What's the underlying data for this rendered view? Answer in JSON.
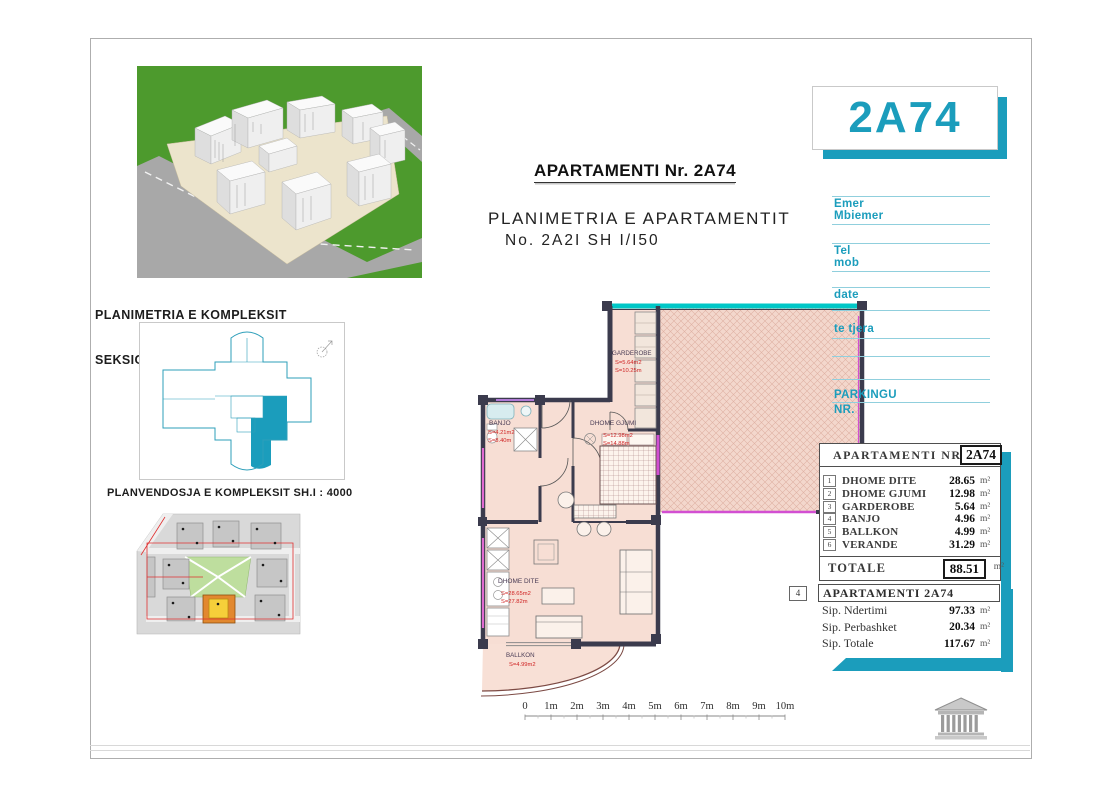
{
  "titles": {
    "main": "APARTAMENTI Nr. 2A74",
    "sub1": "PLANIMETRIA E APARTAMENTIT",
    "sub2": "No. 2A2I SH I/I50"
  },
  "left_panel": {
    "title1": "PLANIMETRIA E KOMPLEKSIT",
    "title2": "SEKSIONI 2  SH I/750",
    "site_title": "PLANVENDOSJA E KOMPLEKSIT SH.I : 4000"
  },
  "badge": {
    "text": "2A74"
  },
  "contact_form": {
    "f1a": "Emer",
    "f1b": "Mbiemer",
    "f2a": "Tel",
    "f2b": "mob",
    "f3": "date",
    "f4": "te tjera",
    "f5a": "PARKINGU",
    "f5b": "NR."
  },
  "area_table": {
    "title": "APARTAMENTI NR.",
    "unit_no": "2A74",
    "rows": [
      {
        "n": "1",
        "name": "DHOME DITE",
        "val": "28.65",
        "u": "m²"
      },
      {
        "n": "2",
        "name": "DHOME GJUMI",
        "val": "12.98",
        "u": "m²"
      },
      {
        "n": "3",
        "name": "GARDEROBE",
        "val": "5.64",
        "u": "m²"
      },
      {
        "n": "4",
        "name": "BANJO",
        "val": "4.96",
        "u": "m²"
      },
      {
        "n": "5",
        "name": "BALLKON",
        "val": "4.99",
        "u": "m²"
      },
      {
        "n": "6",
        "name": "VERANDE",
        "val": "31.29",
        "u": "m²"
      }
    ],
    "total_label": "TOTALE",
    "total_val": "88.51",
    "total_u": "m²"
  },
  "summary_table": {
    "index": "4",
    "title": "APARTAMENTI 2A74",
    "rows": [
      {
        "name": "Sip. Ndertimi",
        "val": "97.33",
        "u": "m²"
      },
      {
        "name": "Sip. Perbashket",
        "val": "20.34",
        "u": "m²"
      },
      {
        "name": "Sip. Totale",
        "val": "117.67",
        "u": "m²"
      }
    ]
  },
  "floorplan": {
    "garderobe": {
      "name": "GARDEROBE",
      "area": "S=5.64m2",
      "per": "S=10.25m"
    },
    "gjumi": {
      "name": "DHOME GJUMI",
      "area": "S=12.98m2",
      "per": "S=14.88m"
    },
    "banjo": {
      "name": "BANJO",
      "area": "S=4.21m2",
      "per": "S=8.40m"
    },
    "dite": {
      "name": "DHOME DITE",
      "area": "S=28.65m2",
      "per": "S=27.82m"
    },
    "ballkon": {
      "name": "BALLKON",
      "area": "S=4.99m2"
    }
  },
  "scale_bar": {
    "labels": [
      "0",
      "1m",
      "2m",
      "3m",
      "4m",
      "5m",
      "6m",
      "7m",
      "8m",
      "9m",
      "10m"
    ]
  }
}
